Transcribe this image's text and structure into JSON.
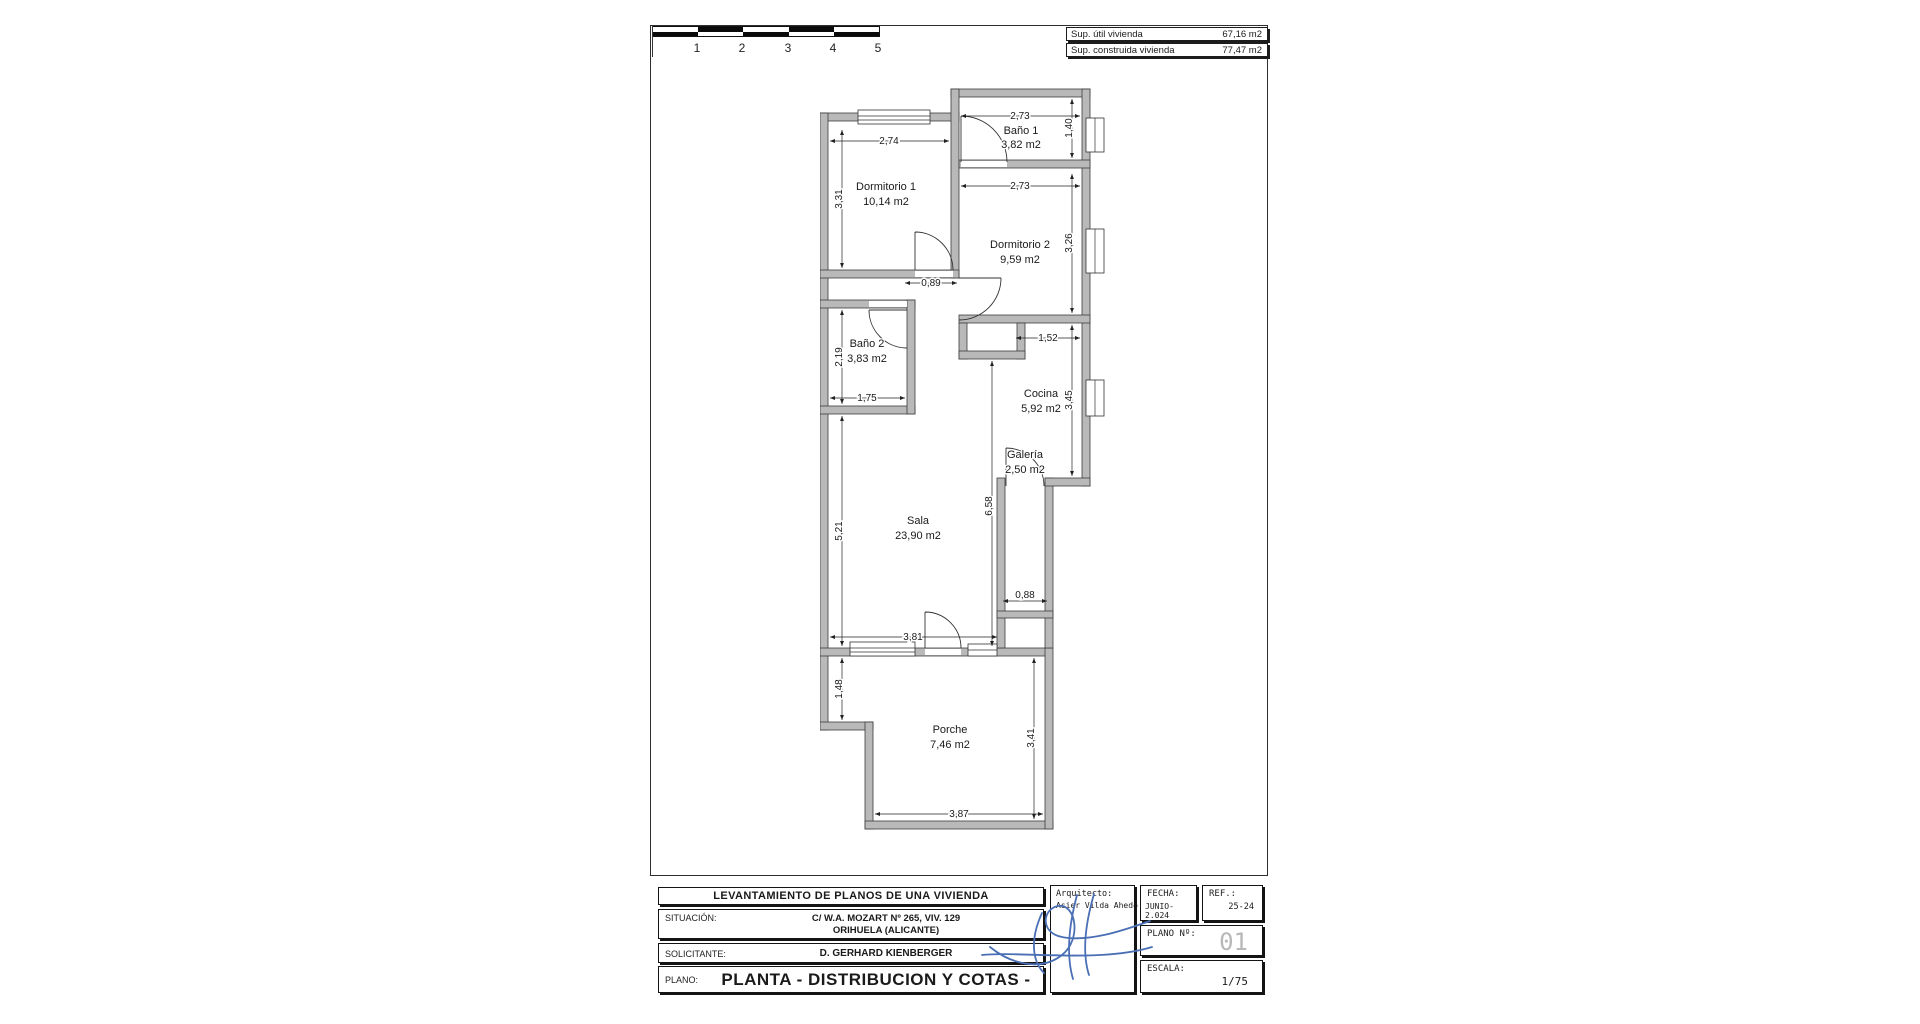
{
  "scale_bar": {
    "labels": [
      "1",
      "2",
      "3",
      "4",
      "5"
    ]
  },
  "area_table": {
    "rows": [
      {
        "label": "Sup. útil vivienda",
        "value": "67,16 m2"
      },
      {
        "label": "Sup. construida vivienda",
        "value": "77,47 m2"
      }
    ]
  },
  "plan": {
    "rooms": {
      "bano1": {
        "name": "Baño 1",
        "area": "3,82 m2"
      },
      "dorm1": {
        "name": "Dormitorio 1",
        "area": "10,14 m2"
      },
      "dorm2": {
        "name": "Dormitorio 2",
        "area": "9,59 m2"
      },
      "bano2": {
        "name": "Baño 2",
        "area": "3,83 m2"
      },
      "cocina": {
        "name": "Cocina",
        "area": "5,92 m2"
      },
      "galeria": {
        "name": "Galería",
        "area": "2,50 m2"
      },
      "sala": {
        "name": "Sala",
        "area": "23,90 m2"
      },
      "porche": {
        "name": "Porche",
        "area": "7,46 m2"
      }
    },
    "dims": {
      "dorm1_width": "2,74",
      "dorm1_height": "3,31",
      "bano1_width": "2,73",
      "bano1_height": "1,40",
      "dorm2_width": "2,73",
      "dorm2_height": "3,26",
      "hall_width": "0,89",
      "bano2_height": "2,19",
      "bano2_width": "1,75",
      "cocina_top": "1,52",
      "cocina_height": "3,45",
      "sala_mid_height": "6,58",
      "sala_height": "5,21",
      "sala_width": "3,81",
      "galeria_width": "0,88",
      "porche_left_height": "1,48",
      "porche_height": "3,41",
      "porche_width": "3,87"
    }
  },
  "title_block": {
    "project_title": "LEVANTAMIENTO DE PLANOS DE UNA VIVIENDA",
    "situacion_label": "SITUACIÓN:",
    "situacion_line1": "C/ W.A. MOZART Nº 265, VIV. 129",
    "situacion_line2": "ORIHUELA (ALICANTE)",
    "solicitante_label": "SOLICITANTE:",
    "solicitante_value": "D. GERHARD KIENBERGER",
    "plano_label": "PLANO:",
    "plano_value": "PLANTA - DISTRIBUCION Y COTAS -",
    "arquitecto_label": "Arquitecto:",
    "arquitecto_value": "Asier Vilda Ahedo",
    "fecha_label": "FECHA:",
    "fecha_value": "JUNIO-2.024",
    "ref_label": "REF.:",
    "ref_value": "25-24",
    "plano_num_label": "PLANO Nº:",
    "plano_num_value": "01",
    "escala_label": "ESCALA:",
    "escala_value": "1/75"
  },
  "colors": {
    "wall_gray": "#b9b9b9",
    "signature_blue": "#4a6fb5",
    "plano_num_gray": "#b8b8b8"
  }
}
